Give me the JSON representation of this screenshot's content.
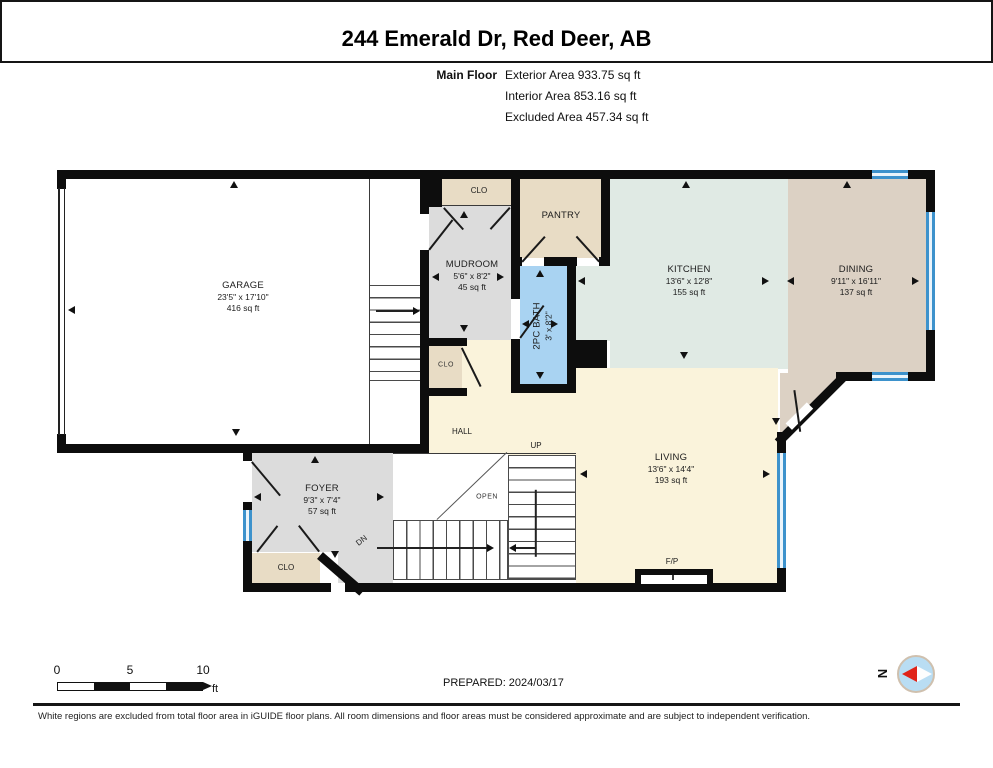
{
  "header": {
    "title": "244 Emerald Dr, Red Deer, AB",
    "floor_label": "Main Floor",
    "area_lines": [
      "Exterior Area 933.75 sq ft",
      "Interior Area 853.16 sq ft",
      "Excluded Area 457.34 sq ft"
    ]
  },
  "rooms": {
    "garage": {
      "name": "GARAGE",
      "dims": "23'5\" x 17'10\"",
      "area": "416 sq ft"
    },
    "mudroom": {
      "name": "MUDROOM",
      "dims": "5'6\" x 8'2\"",
      "area": "45 sq ft"
    },
    "clo_top": {
      "name": "CLO"
    },
    "clo_hall": {
      "name": "CLO"
    },
    "clo_foyer": {
      "name": "CLO"
    },
    "pantry": {
      "name": "PANTRY"
    },
    "bath": {
      "name": "2PC BATH",
      "dims": "3' x 8'2\""
    },
    "kitchen": {
      "name": "KITCHEN",
      "dims": "13'6\" x 12'8\"",
      "area": "155 sq ft"
    },
    "dining": {
      "name": "DINING",
      "dims": "9'11\" x 16'11\"",
      "area": "137 sq ft"
    },
    "living": {
      "name": "LIVING",
      "dims": "13'6\" x 14'4\"",
      "area": "193 sq ft"
    },
    "foyer": {
      "name": "FOYER",
      "dims": "9'3\" x 7'4\"",
      "area": "57 sq ft"
    },
    "hall": {
      "name": "HALL"
    }
  },
  "plan_labels": {
    "up": "UP",
    "dn": "DN",
    "open": "OPEN",
    "fireplace": "F/P"
  },
  "footer": {
    "scale_ticks": [
      "0",
      "5",
      "10"
    ],
    "scale_unit": "ft",
    "prepared": "PREPARED: 2024/03/17",
    "compass_north": "N",
    "disclaimer": "White regions are excluded from total floor area in iGUIDE floor plans. All room dimensions and floor areas must be considered approximate and are subject to independent verification."
  },
  "colors": {
    "wall": "#0d0d0d",
    "closet_tan": "#e8dcc5",
    "room_gray": "#dcdcdc",
    "bath_blue": "#a9d3f2",
    "kitchen_mint": "#e0eae4",
    "dining_tan": "#dcd1c4",
    "living_cream": "#faf3db",
    "window_blue": "#3d92cc",
    "compass_red": "#e02318",
    "compass_blue": "#b9ddf3"
  }
}
